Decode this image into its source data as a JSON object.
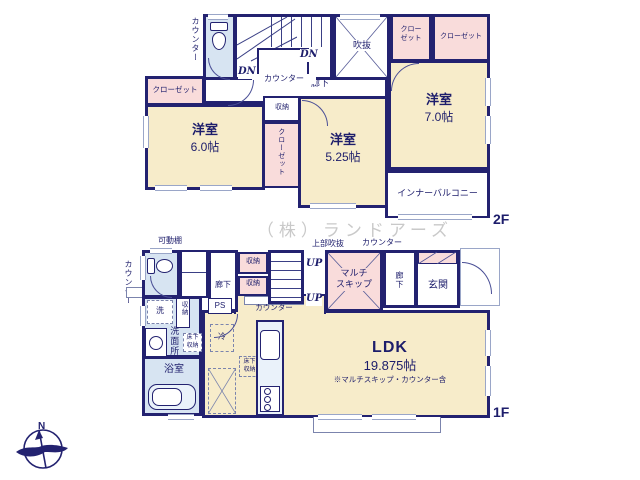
{
  "colors": {
    "wall": "#232270",
    "ink": "#1d1d6b",
    "cream": "#f7ecca",
    "pink": "#f9dcdb",
    "blue": "#d7e4f2",
    "bluelight": "#eaf2fa",
    "win": "#9aa6c8",
    "light": "#7b84ad",
    "step": "#3a3f85",
    "wm": "#c9c9c9"
  },
  "watermark": "（株）ランドアーズ",
  "compass": {
    "north": "N"
  },
  "floor2": {
    "floor_label": "2F",
    "counter_outside": "カウンター",
    "dn_a": "DN",
    "dn_b": "DN",
    "stair_counter": "カウンター",
    "void": "吹抜",
    "closet_small": "クロー\nゼット",
    "closet_right": "クローゼット",
    "closet_left": "クローゼット",
    "hallway": "廊下",
    "storage": "収納",
    "closet_vertical": "クローゼット",
    "inner_balcony": "インナーバルコニー",
    "rooms": {
      "west7": {
        "name": "洋室",
        "size": "7.0帖"
      },
      "west6": {
        "name": "洋室",
        "size": "6.0帖"
      },
      "west525": {
        "name": "洋室",
        "size": "5.25帖"
      }
    }
  },
  "floor1": {
    "floor_label": "1F",
    "movable_shelf": "可動棚",
    "counter_outside": "カウンター",
    "upper_void": "上部吹抜",
    "counter_top": "カウンター",
    "hallway_left": "廊下",
    "storage_upper": "収納",
    "storage_lower": "収納",
    "up_a": "UP",
    "up_b": "UP",
    "multi_skip": "マルチ\nスキップ",
    "hallway_right": "廊下",
    "entrance": "玄関",
    "counter_mid": "カウンター",
    "ps": "PS",
    "washer": "洗",
    "storage_vertical": "収納",
    "washroom": "洗面所",
    "underfloor_1": "床下\n収納",
    "bathroom": "浴室",
    "fridge": "冷",
    "underfloor_2": "床下\n収納",
    "ldk": {
      "name": "LDK",
      "size": "19.875帖",
      "note": "※マルチスキップ・カウンター含"
    }
  }
}
